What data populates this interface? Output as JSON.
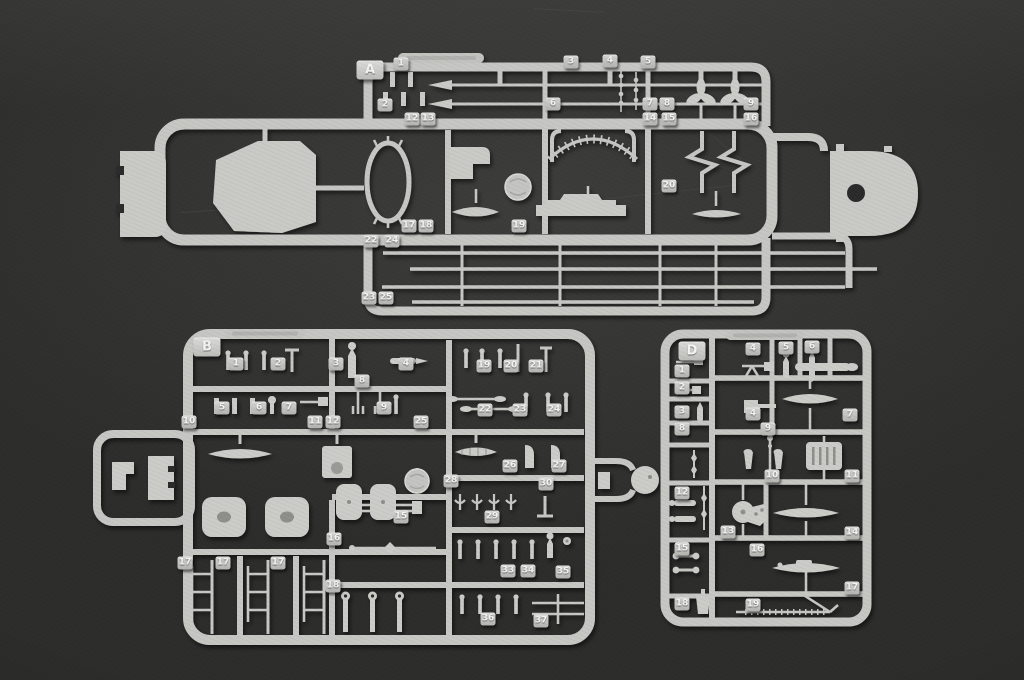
{
  "scene": {
    "description": "Photograph of three light-grey injection-moulded plastic model kit sprues (runners A, B and D) holding small warship parts - masts, propellers, boats, turret bases, davits and fittings - laid on a dark charcoal background",
    "background_color": "#2c2c2b",
    "sprue_color": "#c7c7c4",
    "tag_text_color": "#f3f3f1"
  },
  "sprues": [
    {
      "id": "A",
      "label": "A",
      "label_pos": {
        "x": 370,
        "y": 70
      },
      "part_numbers": [
        {
          "n": "1",
          "x": 401,
          "y": 64
        },
        {
          "n": "3",
          "x": 571,
          "y": 62
        },
        {
          "n": "4",
          "x": 610,
          "y": 61
        },
        {
          "n": "5",
          "x": 648,
          "y": 62
        },
        {
          "n": "2",
          "x": 385,
          "y": 105
        },
        {
          "n": "6",
          "x": 553,
          "y": 104
        },
        {
          "n": "7",
          "x": 650,
          "y": 104
        },
        {
          "n": "8",
          "x": 667,
          "y": 104
        },
        {
          "n": "9",
          "x": 751,
          "y": 104
        },
        {
          "n": "12",
          "x": 412,
          "y": 119
        },
        {
          "n": "13",
          "x": 428,
          "y": 119
        },
        {
          "n": "14",
          "x": 650,
          "y": 119
        },
        {
          "n": "15",
          "x": 669,
          "y": 119
        },
        {
          "n": "16",
          "x": 751,
          "y": 119
        },
        {
          "n": "20",
          "x": 669,
          "y": 186
        },
        {
          "n": "17",
          "x": 409,
          "y": 226
        },
        {
          "n": "18",
          "x": 426,
          "y": 226
        },
        {
          "n": "19",
          "x": 519,
          "y": 226
        },
        {
          "n": "22",
          "x": 371,
          "y": 241
        },
        {
          "n": "24",
          "x": 392,
          "y": 241
        },
        {
          "n": "23",
          "x": 369,
          "y": 298
        },
        {
          "n": "25",
          "x": 386,
          "y": 298
        }
      ]
    },
    {
      "id": "B",
      "label": "B",
      "label_pos": {
        "x": 207,
        "y": 347
      },
      "part_numbers": [
        {
          "n": "1",
          "x": 236,
          "y": 364
        },
        {
          "n": "2",
          "x": 278,
          "y": 364
        },
        {
          "n": "3",
          "x": 336,
          "y": 364
        },
        {
          "n": "4",
          "x": 406,
          "y": 364
        },
        {
          "n": "19",
          "x": 484,
          "y": 366
        },
        {
          "n": "20",
          "x": 511,
          "y": 366
        },
        {
          "n": "21",
          "x": 536,
          "y": 366
        },
        {
          "n": "8",
          "x": 362,
          "y": 381
        },
        {
          "n": "5",
          "x": 222,
          "y": 408
        },
        {
          "n": "6",
          "x": 259,
          "y": 408
        },
        {
          "n": "7",
          "x": 289,
          "y": 408
        },
        {
          "n": "9",
          "x": 384,
          "y": 408
        },
        {
          "n": "22",
          "x": 485,
          "y": 410
        },
        {
          "n": "23",
          "x": 520,
          "y": 410
        },
        {
          "n": "24",
          "x": 554,
          "y": 410
        },
        {
          "n": "10",
          "x": 189,
          "y": 422
        },
        {
          "n": "11",
          "x": 315,
          "y": 422
        },
        {
          "n": "12",
          "x": 333,
          "y": 422
        },
        {
          "n": "25",
          "x": 421,
          "y": 422
        },
        {
          "n": "26",
          "x": 510,
          "y": 466
        },
        {
          "n": "27",
          "x": 559,
          "y": 466
        },
        {
          "n": "28",
          "x": 451,
          "y": 481
        },
        {
          "n": "30",
          "x": 546,
          "y": 484
        },
        {
          "n": "15",
          "x": 401,
          "y": 517
        },
        {
          "n": "29",
          "x": 492,
          "y": 517
        },
        {
          "n": "16",
          "x": 334,
          "y": 539
        },
        {
          "n": "17",
          "x": 185,
          "y": 563
        },
        {
          "n": "17",
          "x": 223,
          "y": 563
        },
        {
          "n": "17",
          "x": 278,
          "y": 563
        },
        {
          "n": "33",
          "x": 508,
          "y": 571
        },
        {
          "n": "34",
          "x": 528,
          "y": 571
        },
        {
          "n": "35",
          "x": 563,
          "y": 572
        },
        {
          "n": "18",
          "x": 333,
          "y": 586
        },
        {
          "n": "36",
          "x": 488,
          "y": 619
        },
        {
          "n": "37",
          "x": 541,
          "y": 621
        }
      ]
    },
    {
      "id": "D",
      "label": "D",
      "label_pos": {
        "x": 692,
        "y": 351
      },
      "part_numbers": [
        {
          "n": "4",
          "x": 753,
          "y": 349
        },
        {
          "n": "5",
          "x": 786,
          "y": 348
        },
        {
          "n": "6",
          "x": 812,
          "y": 347
        },
        {
          "n": "1",
          "x": 682,
          "y": 371
        },
        {
          "n": "2",
          "x": 682,
          "y": 388
        },
        {
          "n": "3",
          "x": 682,
          "y": 412
        },
        {
          "n": "4",
          "x": 753,
          "y": 414
        },
        {
          "n": "7",
          "x": 850,
          "y": 415
        },
        {
          "n": "8",
          "x": 682,
          "y": 429
        },
        {
          "n": "9",
          "x": 768,
          "y": 429
        },
        {
          "n": "10",
          "x": 772,
          "y": 476
        },
        {
          "n": "11",
          "x": 852,
          "y": 476
        },
        {
          "n": "12",
          "x": 682,
          "y": 493
        },
        {
          "n": "13",
          "x": 728,
          "y": 532
        },
        {
          "n": "14",
          "x": 852,
          "y": 533
        },
        {
          "n": "15",
          "x": 682,
          "y": 549
        },
        {
          "n": "16",
          "x": 757,
          "y": 550
        },
        {
          "n": "17",
          "x": 852,
          "y": 588
        },
        {
          "n": "18",
          "x": 682,
          "y": 604
        },
        {
          "n": "19",
          "x": 753,
          "y": 605
        }
      ]
    }
  ]
}
